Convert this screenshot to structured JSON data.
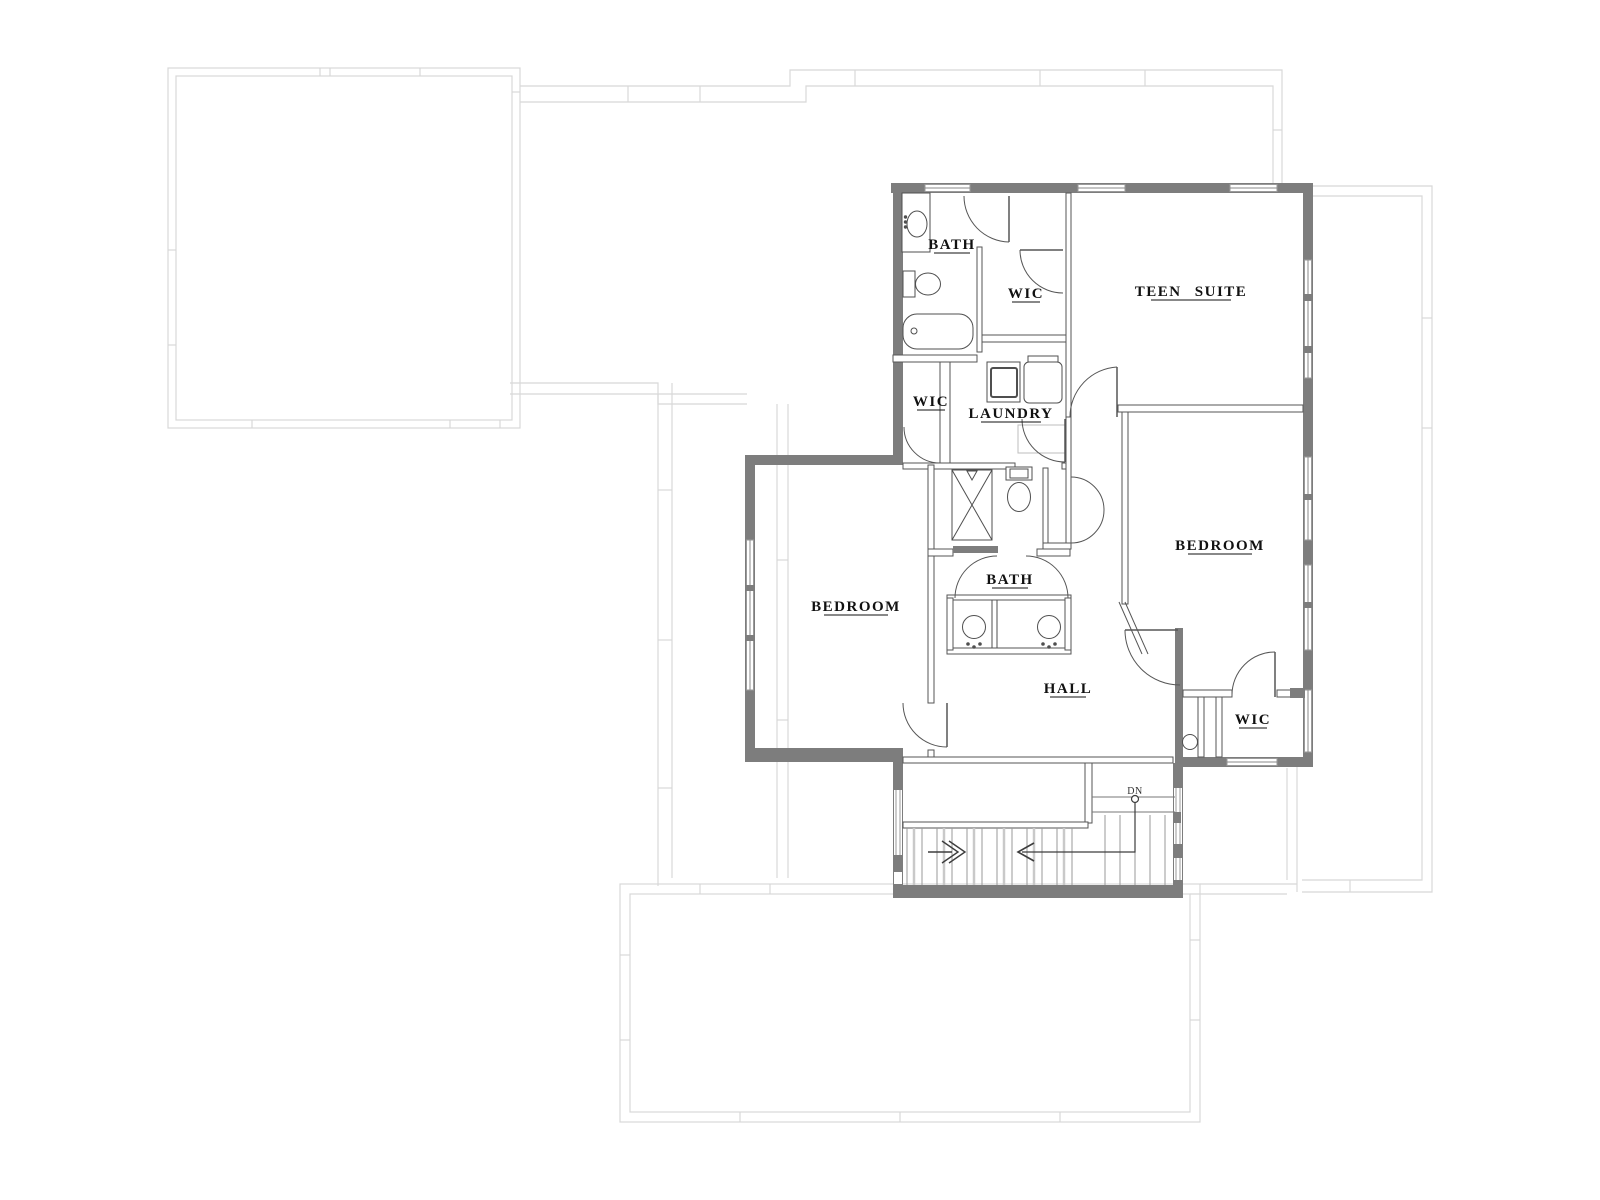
{
  "colors": {
    "wall": "#7d7d7d",
    "line": "#565656",
    "fixture": "#4f4f4f",
    "light_outline": "#d8d8d8",
    "tread": "#9a9a9a",
    "text": "#111111"
  },
  "plan": {
    "rooms": [
      {
        "id": "bath-upper",
        "label": "BATH"
      },
      {
        "id": "wic-upper",
        "label": "WIC"
      },
      {
        "id": "teen-suite",
        "label": "TEEN SUITE"
      },
      {
        "id": "wic-mid",
        "label": "WIC"
      },
      {
        "id": "laundry",
        "label": "LAUNDRY"
      },
      {
        "id": "bedroom-left",
        "label": "BEDROOM"
      },
      {
        "id": "bath-center",
        "label": "BATH"
      },
      {
        "id": "hall",
        "label": "HALL"
      },
      {
        "id": "bedroom-right",
        "label": "BEDROOM"
      },
      {
        "id": "wic-lower",
        "label": "WIC"
      }
    ],
    "stairs": {
      "dn_label": "DN"
    },
    "fixtures": [
      "vanity-sink",
      "toilet",
      "bathtub",
      "shower",
      "washer",
      "dryer",
      "double-vanity-sinks",
      "toilet",
      "closet-fixture"
    ]
  }
}
